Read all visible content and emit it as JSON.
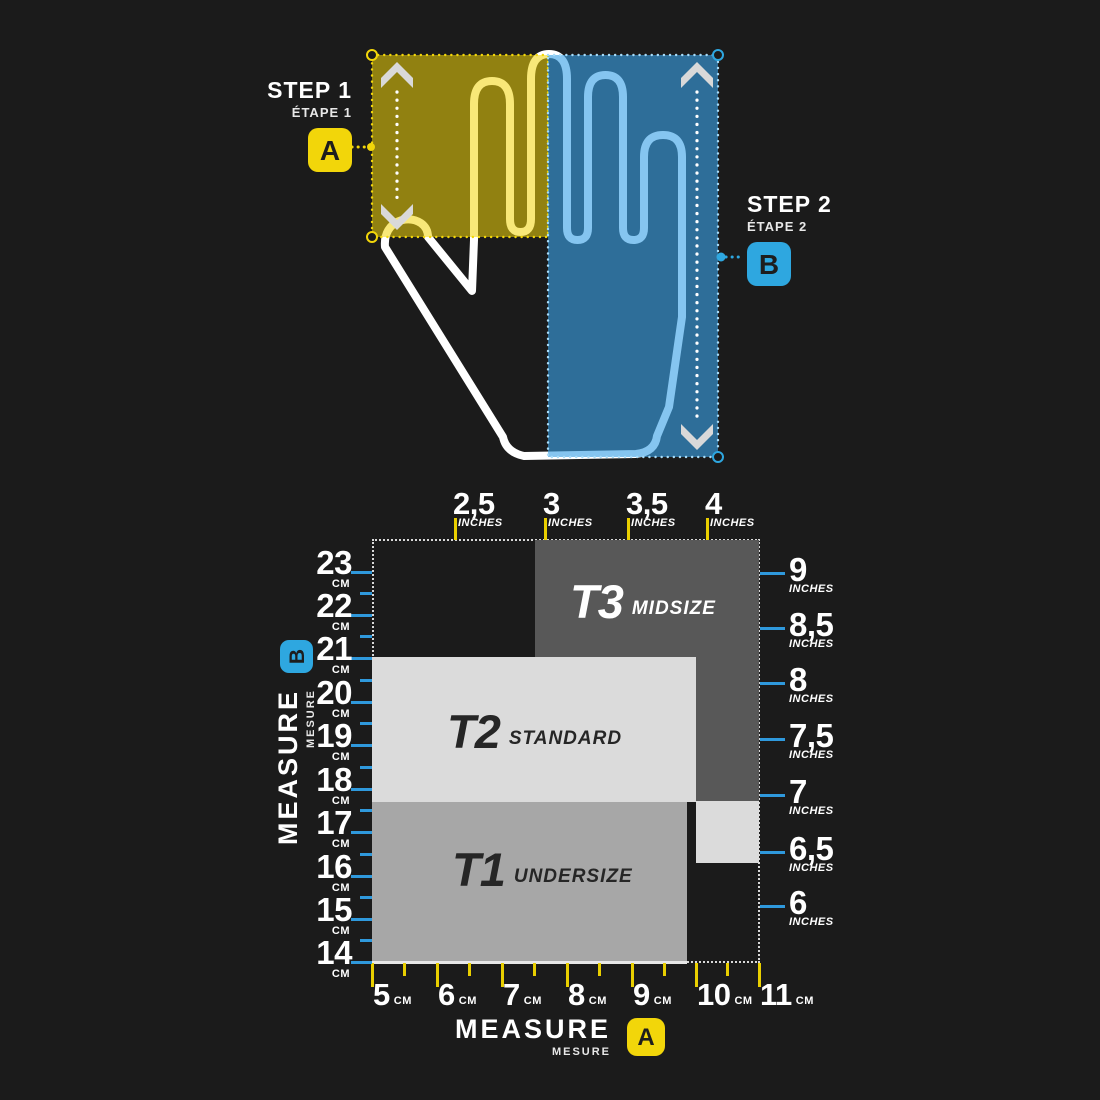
{
  "colors": {
    "background": "#1b1b1b",
    "accent_yellow": "#f2d60a",
    "accent_blue": "#2ea7e0",
    "tick_blue": "#2f99dc",
    "tick_yellow": "#e9cf00",
    "zone_t3": "#585858",
    "zone_t2": "#dbdbdb",
    "zone_t1": "#a7a7a7"
  },
  "hand_figure": {
    "step1": {
      "title": "STEP 1",
      "subtitle": "ÉTAPE 1",
      "badge": "A"
    },
    "step2": {
      "title": "STEP 2",
      "subtitle": "ÉTAPE 2",
      "badge": "B"
    },
    "width_measure_overlay": "A = hand width (yellow box)",
    "length_measure_overlay": "B = hand length (blue box)"
  },
  "chart_data": {
    "type": "heatmap",
    "title": "Glove size zones by hand width (A) and hand length (B)",
    "x_axis_bottom": {
      "unit_label": "CM",
      "ticks": [
        "5",
        "6",
        "7",
        "8",
        "9",
        "10",
        "11"
      ],
      "range_cm": [
        5,
        11
      ]
    },
    "x_axis_top": {
      "unit_label": "INCHES",
      "ticks": [
        "2,5",
        "3",
        "3,5",
        "4"
      ]
    },
    "y_axis_left": {
      "unit_label": "CM",
      "ticks": [
        "23",
        "22",
        "21",
        "20",
        "19",
        "18",
        "17",
        "16",
        "15",
        "14"
      ],
      "range_cm": [
        23,
        14
      ]
    },
    "y_axis_right": {
      "unit_label": "INCHES",
      "ticks": [
        "9",
        "8,5",
        "8",
        "7,5",
        "7",
        "6,5",
        "6"
      ]
    },
    "zones": [
      {
        "code": "T1",
        "name": "UNDERSIZE",
        "color": "#a7a7a7",
        "hand_width_cm": [
          5,
          9.9
        ],
        "hand_length_cm": [
          14,
          17.5
        ]
      },
      {
        "code": "T2",
        "name": "STANDARD",
        "color": "#dbdbdb",
        "hand_width_cm": [
          5,
          10
        ],
        "hand_length_cm": [
          17.5,
          21
        ]
      },
      {
        "code": "T3",
        "name": "MIDSIZE",
        "color": "#585858",
        "hand_width_cm": [
          7.5,
          11
        ],
        "hand_length_cm": [
          17.8,
          23.5
        ]
      }
    ],
    "axis_titles": {
      "bottom": {
        "label": "MEASURE",
        "sublabel": "MESURE",
        "badge": "A"
      },
      "left": {
        "label": "MEASURE",
        "sublabel": "MESURE",
        "badge": "B"
      }
    },
    "legend_position": "none",
    "grid": false
  }
}
